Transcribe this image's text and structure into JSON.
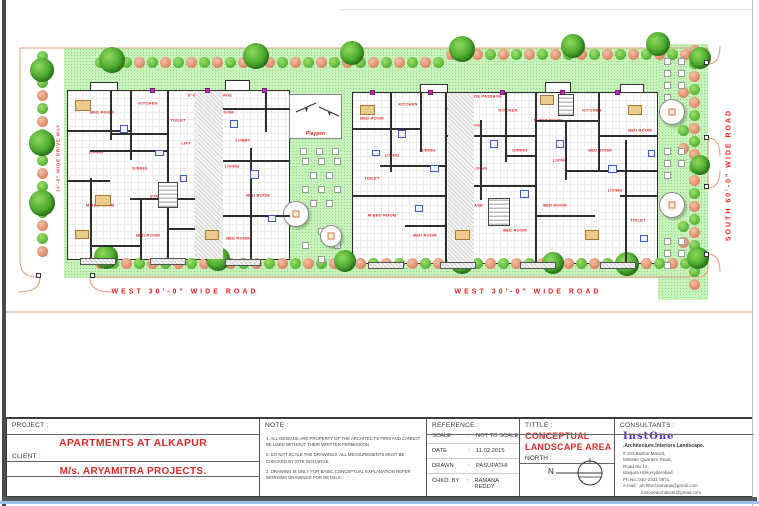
{
  "plan": {
    "road_labels": {
      "west_road_left": "WEST  30'-0\"  WIDE ROAD",
      "west_road_right": "WEST  30'-0\"  WIDE ROAD",
      "south_road": "SOUTH 60'-0\" WIDE ROAD",
      "driveway": "14'-0\" WIDE DRIVE WAY"
    },
    "playpen_label": "Playpen",
    "room_labels": [
      {
        "t": "BED ROOM",
        "x": 102,
        "y": 112
      },
      {
        "t": "KITCHEN",
        "x": 148,
        "y": 103
      },
      {
        "t": "LIVING",
        "x": 96,
        "y": 152
      },
      {
        "t": "DINING",
        "x": 140,
        "y": 168
      },
      {
        "t": "M.BED ROOM",
        "x": 100,
        "y": 205
      },
      {
        "t": "BED ROOM",
        "x": 148,
        "y": 235
      },
      {
        "t": "TOILET",
        "x": 178,
        "y": 120
      },
      {
        "t": "LIFT",
        "x": 186,
        "y": 143
      },
      {
        "t": "STAIR CASE",
        "x": 163,
        "y": 196
      },
      {
        "t": "BED ROOM",
        "x": 222,
        "y": 112
      },
      {
        "t": "LOBBY",
        "x": 243,
        "y": 140
      },
      {
        "t": "LIVING",
        "x": 232,
        "y": 166
      },
      {
        "t": "BED ROOM",
        "x": 258,
        "y": 195
      },
      {
        "t": "DINING",
        "x": 210,
        "y": 206
      },
      {
        "t": "BED ROOM",
        "x": 238,
        "y": 238
      },
      {
        "t": "5'-0\" WIDE PASSAGE",
        "x": 210,
        "y": 95
      },
      {
        "t": "BED ROOM",
        "x": 372,
        "y": 118
      },
      {
        "t": "KITCHEN",
        "x": 408,
        "y": 104
      },
      {
        "t": "LIVING",
        "x": 392,
        "y": 155
      },
      {
        "t": "TOILET",
        "x": 372,
        "y": 178
      },
      {
        "t": "M.BED ROOM",
        "x": 382,
        "y": 215
      },
      {
        "t": "BED ROOM",
        "x": 425,
        "y": 235
      },
      {
        "t": "DINING",
        "x": 428,
        "y": 150
      },
      {
        "t": "LIFT",
        "x": 452,
        "y": 108
      },
      {
        "t": "BED ROOM",
        "x": 470,
        "y": 125
      },
      {
        "t": "LIVING",
        "x": 480,
        "y": 168
      },
      {
        "t": "STAIR CASE",
        "x": 470,
        "y": 205
      },
      {
        "t": "KITCHEN",
        "x": 508,
        "y": 110
      },
      {
        "t": "DINING",
        "x": 520,
        "y": 150
      },
      {
        "t": "BED ROOM",
        "x": 515,
        "y": 230
      },
      {
        "t": "M.BED ROOM",
        "x": 548,
        "y": 120
      },
      {
        "t": "LIVING",
        "x": 560,
        "y": 160
      },
      {
        "t": "BED ROOM",
        "x": 555,
        "y": 205
      },
      {
        "t": "KITCHEN",
        "x": 592,
        "y": 110
      },
      {
        "t": "BED ROOM",
        "x": 600,
        "y": 150
      },
      {
        "t": "LIVING",
        "x": 615,
        "y": 190
      },
      {
        "t": "BED ROOM",
        "x": 640,
        "y": 130
      },
      {
        "t": "TOILET",
        "x": 638,
        "y": 220
      },
      {
        "t": "5'-0\" WIDE PASSAGE",
        "x": 480,
        "y": 96
      }
    ]
  },
  "title_block": {
    "project": {
      "label": "PROJECT :",
      "value": "APARTMENTS AT ALKAPUR"
    },
    "client": {
      "label": "CLIENT :",
      "value": "M/s. ARYAMITRA PROJECTS."
    },
    "note": {
      "label": "NOTE :",
      "items": [
        "1. ALL DESIGNS ARE PROPERTY OF THE ARCHITECT'S FIRM AND CANNOT BE USED WITHOUT THEIR WRITTEN PERMISSION",
        "2. DO NOT SCALE THE DRAWINGS. ALL MEASUREMENTS MUST BE CHECKED BY SITE INCHARGE.",
        "3. DRAWING IS ONLY FOR BASIC CONCEPTUAL EXPLANATION REFER WORKING DRAWINGS FOR DETAILS."
      ]
    },
    "reference": {
      "label": "REFERENCE :",
      "rows": [
        {
          "k": "SCALE",
          "v": "NOT TO SCALE"
        },
        {
          "k": "DATE",
          "v": "11.02.2015"
        },
        {
          "k": "DRAWN",
          "v": "PASUPATHI"
        },
        {
          "k": "CHKD. BY",
          "v": "RAMANA REDDY"
        }
      ]
    },
    "title": {
      "label": "TITTLE :",
      "value_line1": "CONCEPTUAL",
      "value_line2": "LANDSCAPE AREA",
      "north_label": "NORTH :",
      "north_letter": "N"
    },
    "consultants": {
      "label": "CONSULTANTS :",
      "logo": "InstOne",
      "tagline": ".Architecture.Interiors.Landscape.",
      "address_lines": [
        "# 103,Burton Manzil,",
        "Minister Quarters Road,",
        "Road No.12,",
        "Banjara Hills,Hyderabad.",
        "Ph.No.:040-2331 0871,",
        "e-mail : architectramana@gmail.com",
        "instonearchitects@gmail.com"
      ]
    }
  },
  "colors": {
    "accent_red": "#d92b2b",
    "label_red": "#e02424",
    "landscape_green": "#c9f2bb",
    "boundary_salmon": "#e39b7b",
    "logo_purple": "#4a35c8"
  }
}
